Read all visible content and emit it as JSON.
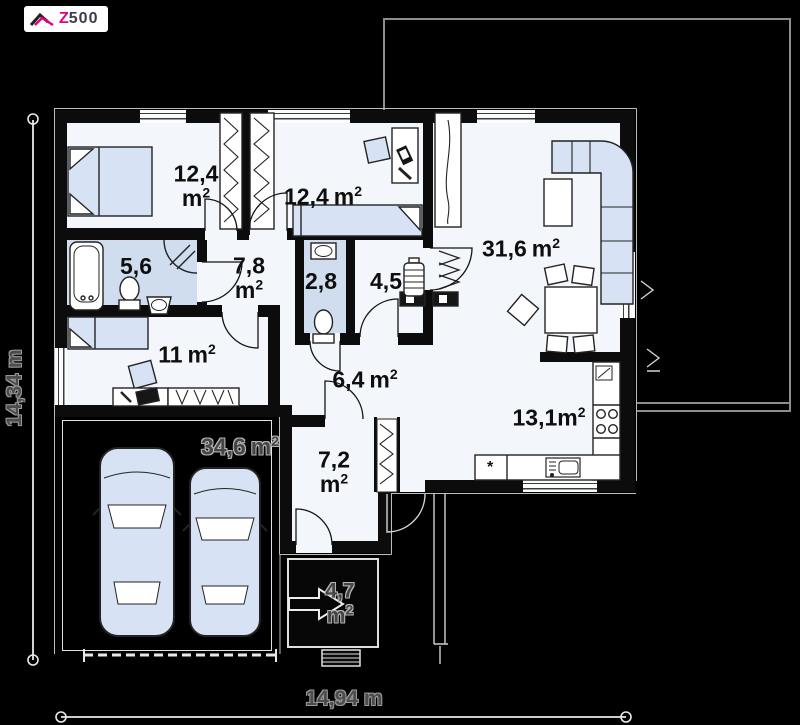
{
  "logo": {
    "z": "Z",
    "suffix": "500"
  },
  "rooms": {
    "bedroom1": {
      "value": "12,4",
      "unit": "m",
      "sup": "2"
    },
    "bedroom2": {
      "value": "12,4",
      "unit": "m",
      "sup": "2"
    },
    "living_room": {
      "value": "31,6",
      "unit": "m",
      "sup": "2"
    },
    "bathroom": {
      "value": "5,6"
    },
    "hall": {
      "value": "7,8",
      "unit": "m",
      "sup": "2"
    },
    "wc": {
      "value": "2,8"
    },
    "utility": {
      "value": "4,5"
    },
    "guest_room": {
      "value": "11",
      "unit": "m",
      "sup": "2"
    },
    "corridor": {
      "value": "6,4",
      "unit": "m",
      "sup": "2"
    },
    "kitchen": {
      "value": "13,1",
      "unit": "m",
      "sup": "2"
    },
    "garage": {
      "value": "34,6",
      "unit": "m",
      "sup": "2"
    },
    "vestibule": {
      "value": "7,2",
      "unit": "m",
      "sup": "2"
    },
    "porch": {
      "value": "4,7",
      "unit": "m",
      "sup": "2"
    }
  },
  "dimensions": {
    "left": "14,34 m",
    "bottom": "14,94 m"
  },
  "kitchen_details": {
    "fridge_marker": "*"
  },
  "colors": {
    "furniture": "#d7e3f4",
    "wet_floor": "#cfddee",
    "brand_pink": "#e5007d"
  }
}
